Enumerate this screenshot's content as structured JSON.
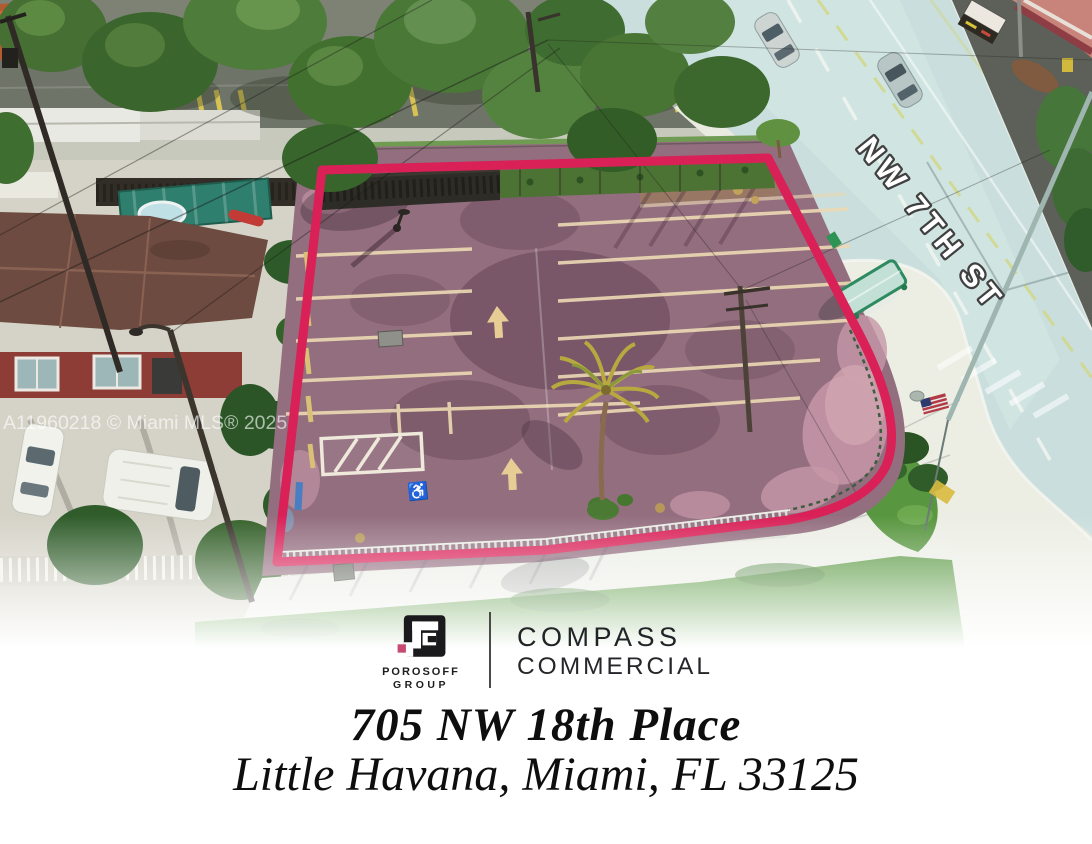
{
  "photo": {
    "street_label": "NW 7TH ST",
    "watermark": "A11960218 © Miami MLS® 2025",
    "outline_color": "#d92057"
  },
  "branding": {
    "porosoff_line1": "POROSOFF",
    "porosoff_line2": "GROUP",
    "porosoff_accent": "#c84a72",
    "compass_line1": "COMPASS",
    "compass_line2": "COMMERCIAL"
  },
  "address": {
    "line1": "705 NW 18th Place",
    "line2": "Little Havana, Miami, FL 33125"
  }
}
